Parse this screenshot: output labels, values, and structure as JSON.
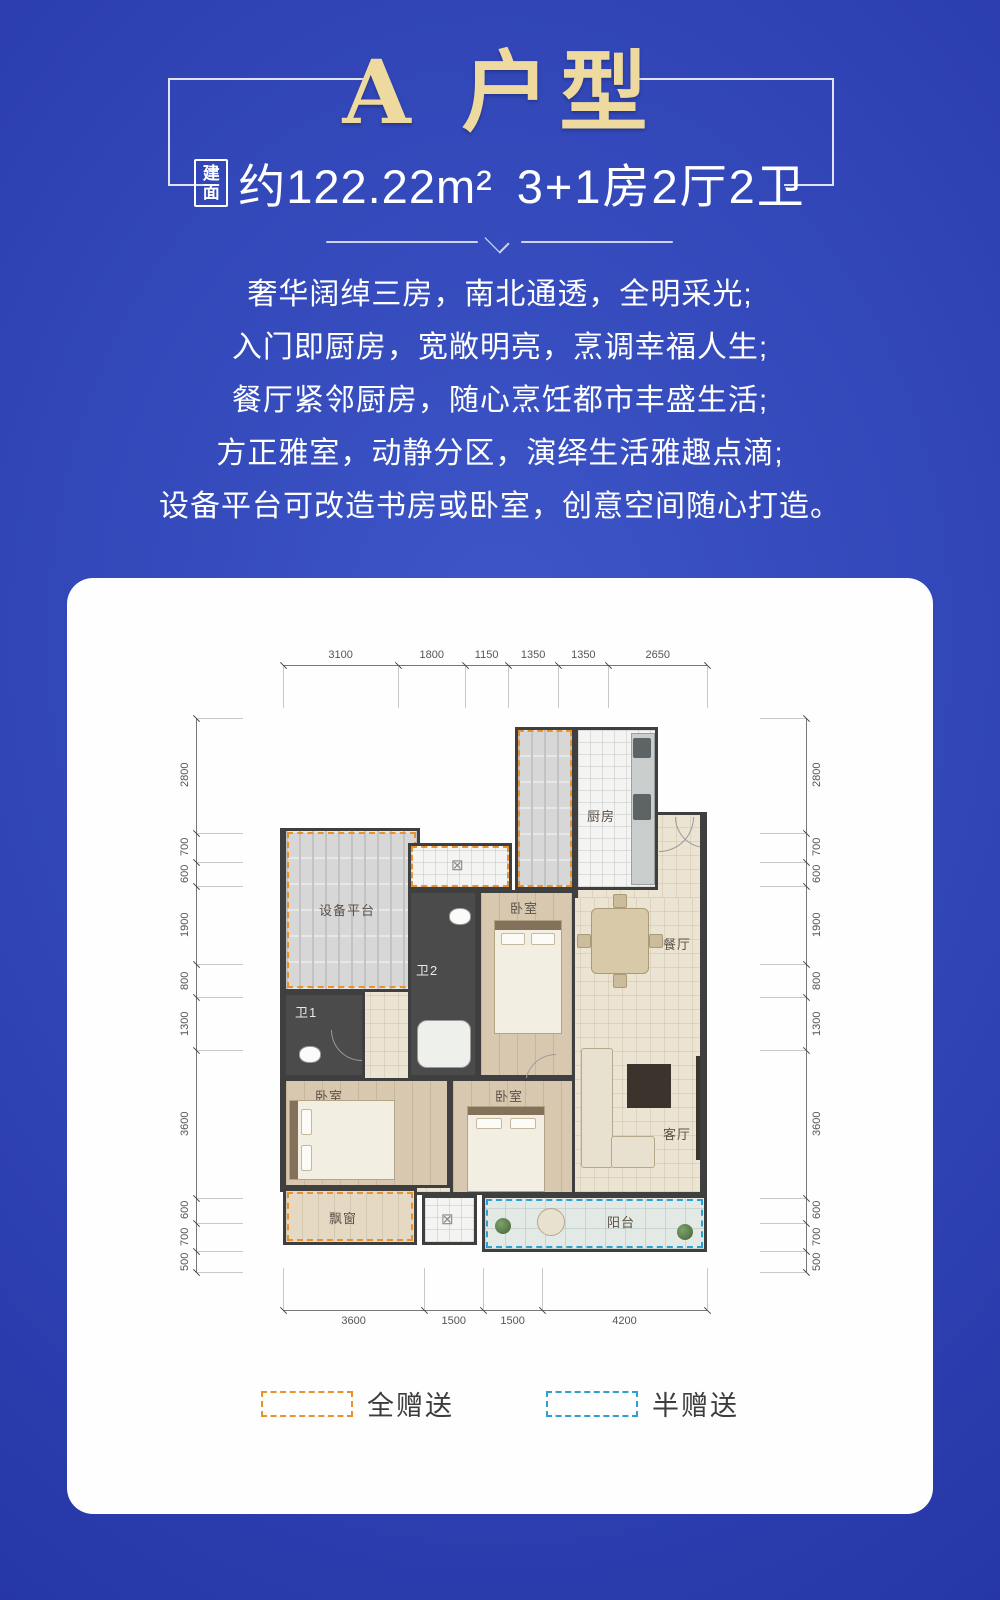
{
  "header": {
    "title": "A 户型",
    "area_box_label": "建面",
    "area_text": "约122.22m²",
    "layout_text": "3+1房2厅2卫"
  },
  "intro_lines": [
    "奢华阔绰三房，南北通透，全明采光;",
    "入门即厨房，宽敞明亮，烹调幸福人生;",
    "餐厅紧邻厨房，随心烹饪都市丰盛生活;",
    "方正雅室，动静分区，演绎生活雅趣点滴;",
    "设备平台可改造书房或卧室，创意空间随心打造。"
  ],
  "floorplan": {
    "rooms": {
      "equipment_platform": "设备平台",
      "kitchen": "厨房",
      "dining": "餐厅",
      "living": "客厅",
      "bedroom_top": "卧室",
      "bedroom_left": "卧室",
      "bedroom_center": "卧室",
      "bath1": "卫1",
      "bath2": "卫2",
      "balcony": "阳台",
      "bay_window": "飘窗"
    },
    "dimensions": {
      "top": [
        3100,
        1800,
        1150,
        1350,
        1350,
        2650
      ],
      "bottom": [
        3600,
        1500,
        1500,
        4200
      ],
      "left": [
        2800,
        700,
        600,
        1900,
        800,
        1300,
        3600,
        600,
        700,
        500
      ],
      "right": [
        2800,
        700,
        600,
        1900,
        800,
        1300,
        3600,
        600,
        700,
        500
      ]
    },
    "legend": [
      {
        "label": "全赠送",
        "color": "#e8922e"
      },
      {
        "label": "半赠送",
        "color": "#2e9fd0"
      }
    ]
  },
  "colors": {
    "background_center": "#3d56c8",
    "background_edge": "#1d2b98",
    "title_gold": "#eeda9f",
    "text_white": "#ffffff",
    "card_bg": "#fefefe",
    "wall": "#3f3f3f",
    "gift_full": "#e8922e",
    "gift_half": "#2e9fd0"
  }
}
